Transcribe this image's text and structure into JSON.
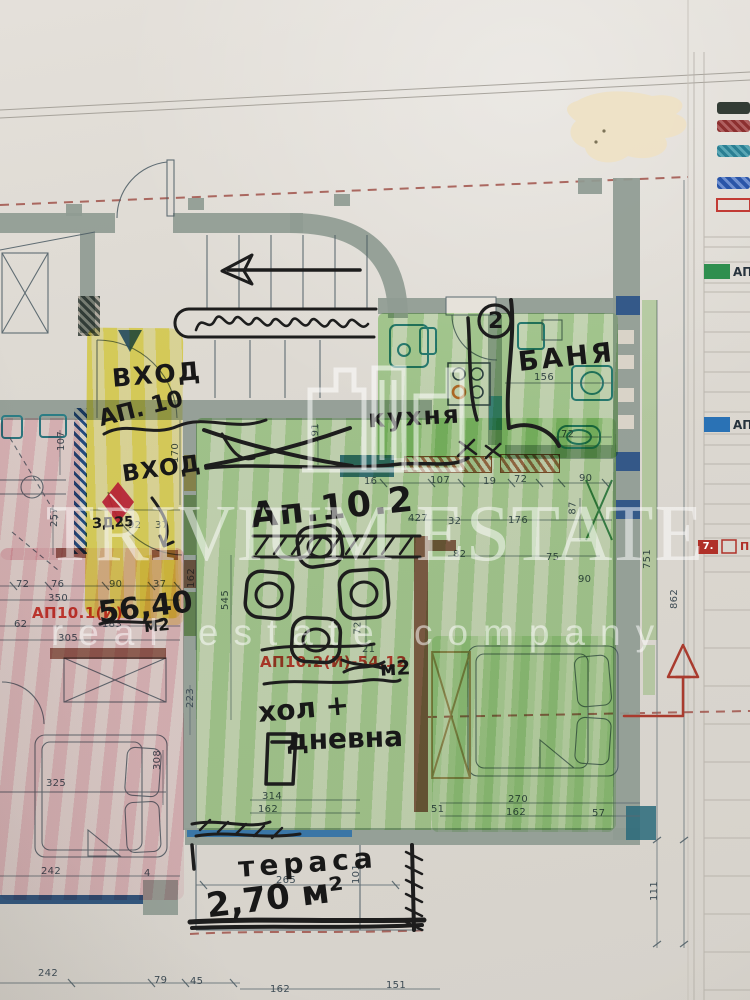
{
  "watermark": {
    "brand": "TRIVIUM ESTATE",
    "tagline": "real estate company"
  },
  "plan": {
    "handwritten": {
      "entrance_top": "ВХОД",
      "apartment_ref": "АП. 10",
      "entrance_lower": "ВХОД",
      "door_note": "ЗД25",
      "apartment_title": "Ап.10.2",
      "kitchen": "кухня",
      "bathroom": "БАНЯ",
      "living_line1": "хол +",
      "living_line2": "дневна",
      "terrace": "тераса",
      "terrace_area": "2,70 м²",
      "area_value": "56,40",
      "area_unit": "м2",
      "ap102_unit": "м2",
      "circle_note": "2"
    },
    "printed": {
      "ap101_label": "АП10.1(И)",
      "ap102_label": "АП10.2(И)-54,12"
    },
    "dims": [
      "170",
      "92",
      "37",
      "156",
      "72",
      "16",
      "107",
      "19",
      "72",
      "90",
      "427",
      "32",
      "176",
      "82",
      "75",
      "87",
      "191",
      "162",
      "545",
      "72",
      "21",
      "90",
      "72",
      "76",
      "90",
      "37",
      "350",
      "62",
      "183",
      "305",
      "107",
      "257",
      "325",
      "308",
      "242",
      "4",
      "223",
      "314",
      "162",
      "51",
      "270",
      "162",
      "57",
      "265",
      "101",
      "751",
      "862",
      "242",
      "79",
      "45",
      "162",
      "151",
      "111"
    ]
  },
  "legend_panel": {
    "row_ap1": "АП1",
    "row_ap2": "АП",
    "row7_num": "7.",
    "row7_text": "П"
  },
  "colors": {
    "highlight_green": "#86d073",
    "highlight_yellow": "#f0e75a",
    "highlight_pink": "#eaa9b8",
    "wall_gray": "#8f9b93",
    "accent_red": "#c0392f",
    "teal": "#2c7d85",
    "navy": "#274f86",
    "marker_black": "#1d1d1d",
    "section_red": "#a0524a",
    "brown_wall": "#8a4a38",
    "tan_pen": "#a8835a",
    "legend_green": "#2f8f4f",
    "legend_blue": "#2a72b5",
    "legend_red": "#b03028",
    "watermark_white": "rgba(255,255,255,0.52)"
  }
}
